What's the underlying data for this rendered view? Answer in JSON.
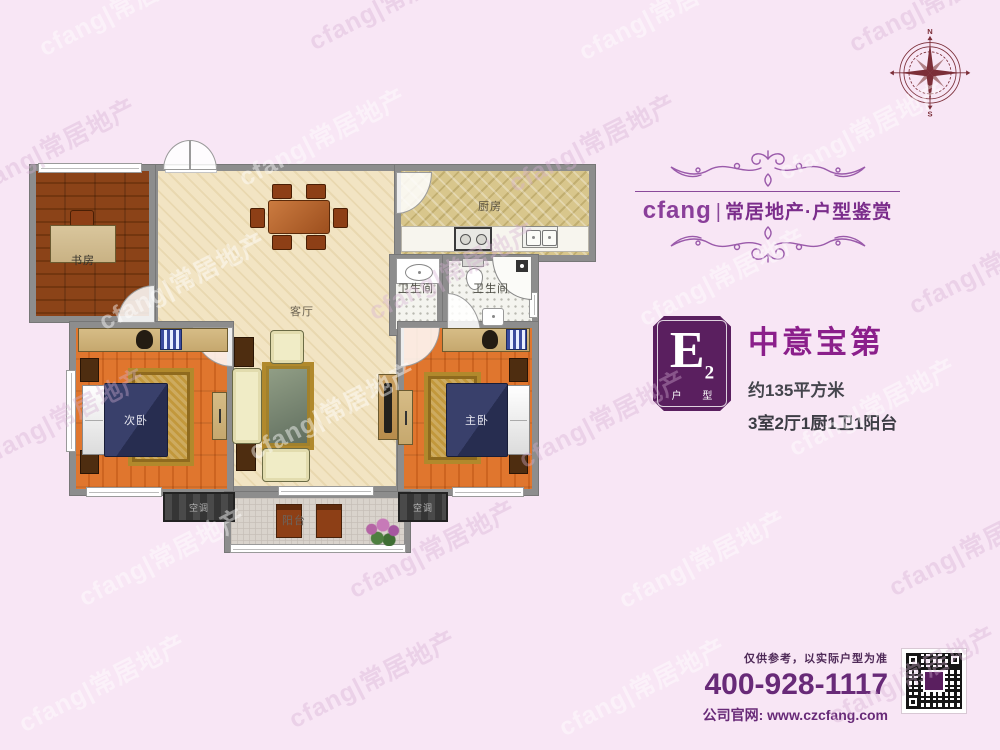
{
  "watermark": {
    "text": "cfang|常居地产"
  },
  "header": {
    "brand": "cfang",
    "divider": "|",
    "tagline": "常居地产·户型鉴赏"
  },
  "compass": {
    "north": "N",
    "south": "S",
    "east": "E",
    "west": "W"
  },
  "listing": {
    "badge_letter": "E",
    "badge_number": "2",
    "badge_caption": "户 型",
    "title": "中意宝第",
    "area": "约135平方米",
    "rooms_summary": "3室2厅1厨1卫1阳台"
  },
  "plan": {
    "rooms": {
      "study": "书房",
      "living": "客厅",
      "kitchen": "厨房",
      "bath_left": "卫生间",
      "bath_right": "卫生间",
      "bedroom_left": "次卧",
      "bedroom_right": "主卧",
      "balcony": "阳台"
    },
    "ac_left": "空调",
    "ac_right": "空调"
  },
  "footer": {
    "disclaimer": "仅供参考，以实际户型为准",
    "phone": "400-928-1117",
    "website": "公司官网: www.czcfang.com"
  },
  "colors": {
    "background": "#f8e6f5",
    "brand_purple": "#7b2d8b",
    "brand_orange": "#f0a232",
    "badge_purple": "#5a1f5f",
    "title_purple": "#8b1f8b",
    "wall_gray": "#8d8d8d",
    "compass_maroon": "#7b2e38"
  }
}
